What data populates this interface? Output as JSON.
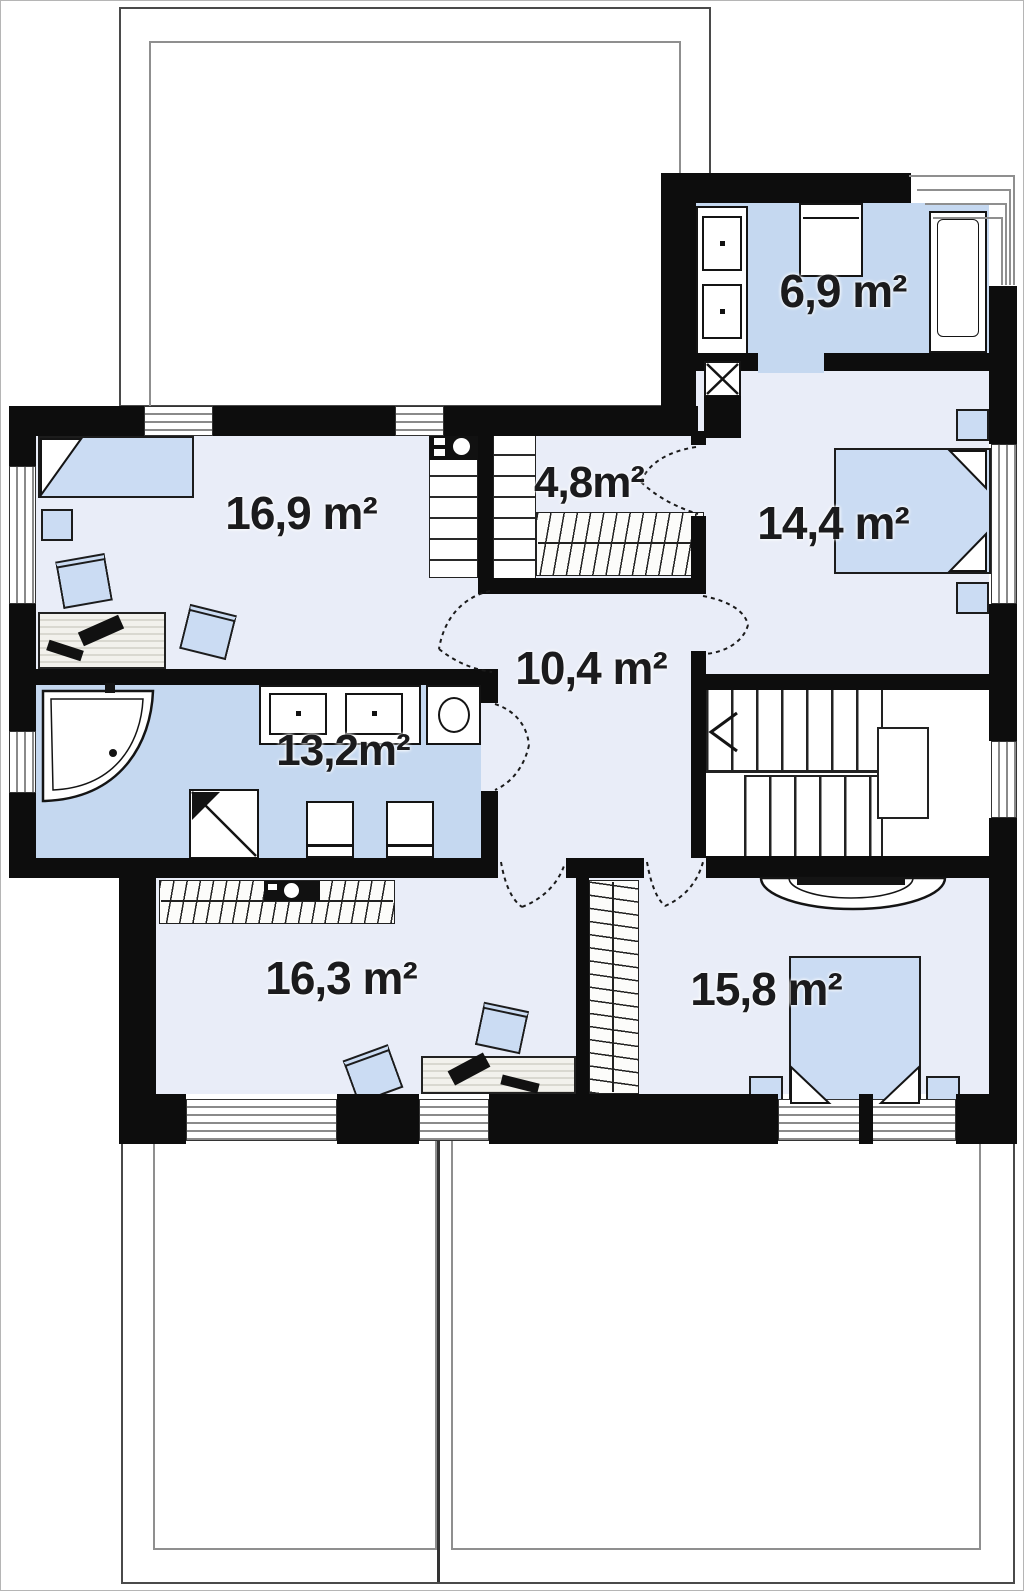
{
  "plan": {
    "type": "floor-plan",
    "rooms": [
      {
        "id": "bathroom-ensuite",
        "area_label": "6,9 m²"
      },
      {
        "id": "bedroom-left",
        "area_label": "16,9 m²"
      },
      {
        "id": "wardrobe",
        "area_label": "4,8m²"
      },
      {
        "id": "bedroom-right",
        "area_label": "14,4 m²"
      },
      {
        "id": "hall",
        "area_label": "10,4 m²"
      },
      {
        "id": "bathroom-main",
        "area_label": "13,2m²"
      },
      {
        "id": "room-bottom-left",
        "area_label": "16,3 m²"
      },
      {
        "id": "bedroom-bottom",
        "area_label": "15,8 m²"
      }
    ],
    "colors": {
      "wall": "#0d0d0d",
      "room_floor": "#e9edf8",
      "wet_floor": "#c5d8f0",
      "furniture": "#cbdcf3",
      "window_line": "#8a8a8a",
      "roof_line": "#555555"
    }
  }
}
